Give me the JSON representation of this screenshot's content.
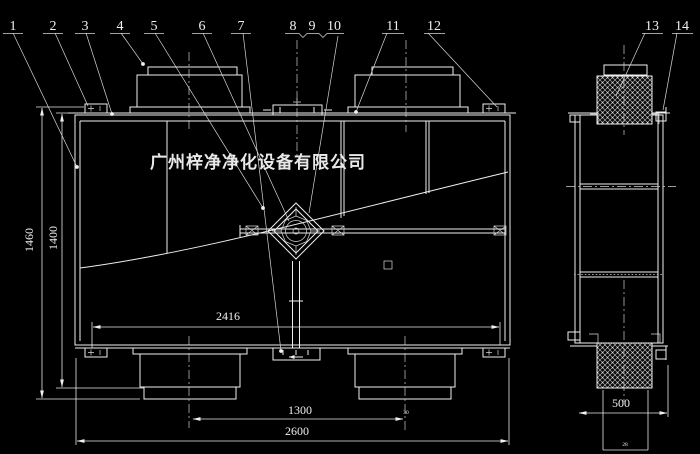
{
  "colors": {
    "background": "#000000",
    "line": "#f0f0f0"
  },
  "watermark": {
    "text": "广州梓净净化设备有限公司"
  },
  "callouts": {
    "n1": "1",
    "n2": "2",
    "n3": "3",
    "n4": "4",
    "n5": "5",
    "n6": "6",
    "n7": "7",
    "n8": "8",
    "n9": "9",
    "n10": "10",
    "n11": "11",
    "n12": "12",
    "n13": "13",
    "n14": "14"
  },
  "dimensions": {
    "overall_height": "1460",
    "body_height": "1400",
    "inner_width": "2416",
    "duct_spacing": "1300",
    "overall_width": "2600",
    "side_duct_width": "500",
    "small_label_right": "30",
    "small_label_side": "28"
  }
}
